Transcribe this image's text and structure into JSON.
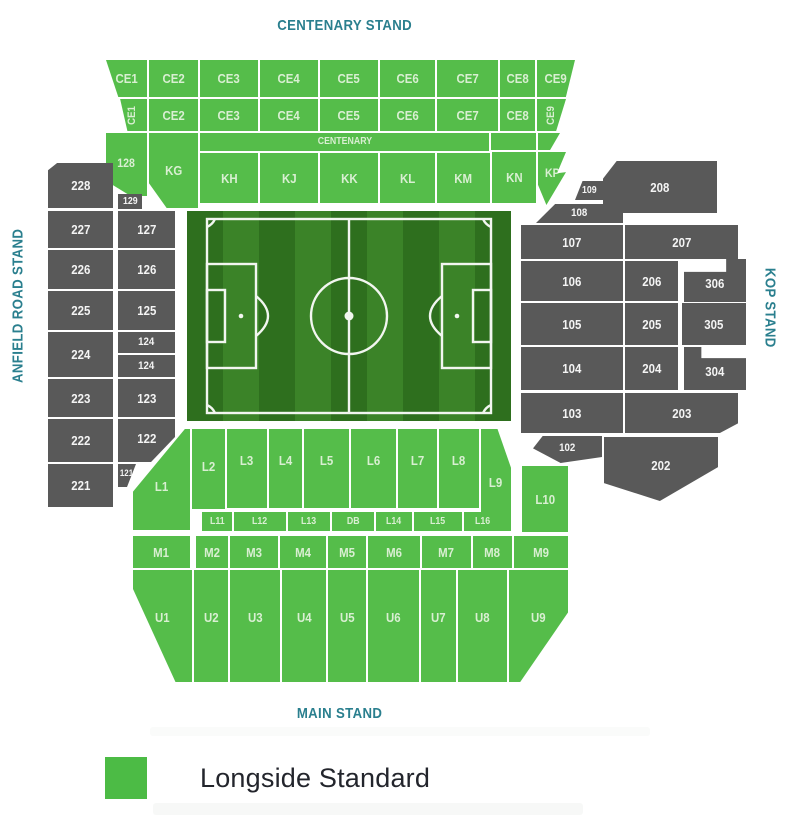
{
  "stands": {
    "top": "CENTENARY STAND",
    "left": "ANFIELD ROAD STAND",
    "right": "KOP STAND",
    "bottom": "MAIN STAND"
  },
  "legend": {
    "items": [
      {
        "label": "Longside Standard",
        "color": "#4cbb45",
        "category": "available"
      }
    ]
  },
  "colors": {
    "green": "#55bd4a",
    "green_text": "#d9efd2",
    "gray": "#595959",
    "gray_text": "#f4f4f4",
    "teal": "#2a7f8e",
    "legend_text": "#23252c",
    "pitch_dark": "#2e6f1e",
    "pitch_light": "#3b8328",
    "pitch_line": "#f2f6f0"
  },
  "pitch": {
    "stripes": 9,
    "x": 187,
    "y": 211,
    "w": 324,
    "h": 210
  },
  "sections": [
    {
      "id": "CE1-upper",
      "label": "CE1",
      "status": "available",
      "x": 106,
      "y": 60,
      "w": 41,
      "h": 37,
      "clip": "polygon(0 0,100% 0,100% 100%,30% 100%)"
    },
    {
      "id": "CE2-upper",
      "label": "CE2",
      "status": "available",
      "x": 149,
      "y": 60,
      "w": 49,
      "h": 37
    },
    {
      "id": "CE3-upper",
      "label": "CE3",
      "status": "available",
      "x": 200,
      "y": 60,
      "w": 58,
      "h": 37
    },
    {
      "id": "CE4-upper",
      "label": "CE4",
      "status": "available",
      "x": 260,
      "y": 60,
      "w": 58,
      "h": 37
    },
    {
      "id": "CE5-upper",
      "label": "CE5",
      "status": "available",
      "x": 320,
      "y": 60,
      "w": 58,
      "h": 37
    },
    {
      "id": "CE6-upper",
      "label": "CE6",
      "status": "available",
      "x": 380,
      "y": 60,
      "w": 55,
      "h": 37
    },
    {
      "id": "CE7-upper",
      "label": "CE7",
      "status": "available",
      "x": 437,
      "y": 60,
      "w": 61,
      "h": 37
    },
    {
      "id": "CE8-upper",
      "label": "CE8",
      "status": "available",
      "x": 500,
      "y": 60,
      "w": 35,
      "h": 37
    },
    {
      "id": "CE9-upper",
      "label": "CE9",
      "status": "available",
      "x": 537,
      "y": 60,
      "w": 38,
      "h": 37,
      "clip": "polygon(0 0,100% 0,76% 100%,0 100%)"
    },
    {
      "id": "CE1-lower",
      "label": "CE1",
      "status": "available",
      "x": 119,
      "y": 99,
      "w": 28,
      "h": 32,
      "rot": true,
      "fs": 11,
      "clip": "polygon(4% 0,100% 0,100% 100%,30% 100%)"
    },
    {
      "id": "CE2-lower",
      "label": "CE2",
      "status": "available",
      "x": 149,
      "y": 99,
      "w": 49,
      "h": 32
    },
    {
      "id": "CE3-lower",
      "label": "CE3",
      "status": "available",
      "x": 200,
      "y": 99,
      "w": 58,
      "h": 32
    },
    {
      "id": "CE4-lower",
      "label": "CE4",
      "status": "available",
      "x": 260,
      "y": 99,
      "w": 58,
      "h": 32
    },
    {
      "id": "CE5-lower",
      "label": "CE5",
      "status": "available",
      "x": 320,
      "y": 99,
      "w": 58,
      "h": 32
    },
    {
      "id": "CE6-lower",
      "label": "CE6",
      "status": "available",
      "x": 380,
      "y": 99,
      "w": 55,
      "h": 32
    },
    {
      "id": "CE7-lower",
      "label": "CE7",
      "status": "available",
      "x": 437,
      "y": 99,
      "w": 61,
      "h": 32
    },
    {
      "id": "CE8-lower",
      "label": "CE8",
      "status": "available",
      "x": 500,
      "y": 99,
      "w": 35,
      "h": 32
    },
    {
      "id": "CE9-lower",
      "label": "CE9",
      "status": "available",
      "x": 537,
      "y": 99,
      "w": 29,
      "h": 32,
      "rot": true,
      "fs": 11,
      "clip": "polygon(0 0,100% 0,66% 100%,0 100%)"
    },
    {
      "id": "centenary-banner",
      "label": "CENTENARY",
      "status": "available",
      "x": 200,
      "y": 133,
      "w": 289,
      "h": 18,
      "fs": 10
    },
    {
      "id": "filler-kn",
      "label": "",
      "status": "available",
      "x": 491,
      "y": 133,
      "w": 45,
      "h": 17
    },
    {
      "id": "filler-kp",
      "label": "",
      "status": "available",
      "x": 538,
      "y": 133,
      "w": 22,
      "h": 17,
      "clip": "polygon(0 0,100% 0,55% 100%,0 100%)"
    },
    {
      "id": "128",
      "label": "128",
      "status": "available",
      "x": 106,
      "y": 133,
      "w": 41,
      "h": 63,
      "fs": 12,
      "dy": -4,
      "clip": "polygon(0 0,100% 0,100% 100%,60% 100%,0 76%)"
    },
    {
      "id": "KG",
      "label": "KG",
      "status": "available",
      "x": 149,
      "y": 133,
      "w": 49,
      "h": 75,
      "clip": "polygon(0 0,100% 0,100% 100%,36% 100%,0 67%)"
    },
    {
      "id": "KH",
      "label": "KH",
      "status": "available",
      "x": 200,
      "y": 153,
      "w": 58,
      "h": 50
    },
    {
      "id": "KJ",
      "label": "KJ",
      "status": "available",
      "x": 260,
      "y": 153,
      "w": 58,
      "h": 50
    },
    {
      "id": "KK",
      "label": "KK",
      "status": "available",
      "x": 320,
      "y": 153,
      "w": 58,
      "h": 50
    },
    {
      "id": "KL",
      "label": "KL",
      "status": "available",
      "x": 380,
      "y": 153,
      "w": 55,
      "h": 50
    },
    {
      "id": "KM",
      "label": "KM",
      "status": "available",
      "x": 437,
      "y": 153,
      "w": 53,
      "h": 50
    },
    {
      "id": "KN",
      "label": "KN",
      "status": "available",
      "x": 492,
      "y": 152,
      "w": 44,
      "h": 51
    },
    {
      "id": "KP",
      "label": "KP",
      "status": "available",
      "x": 538,
      "y": 152,
      "w": 28,
      "h": 53,
      "fs": 12,
      "dy": -12,
      "clip": "polygon(0 0,100% 0,68% 40%,100% 38%,30% 100%,0 62%)"
    },
    {
      "id": "109",
      "label": "109",
      "status": "unavailable",
      "x": 575,
      "y": 181,
      "w": 29,
      "h": 19,
      "fs": 10,
      "clip": "polygon(26% 0,100% 0,100% 100%,0 100%)"
    },
    {
      "id": "208",
      "label": "208",
      "status": "unavailable",
      "x": 603,
      "y": 161,
      "w": 114,
      "h": 52,
      "clip": "polygon(0 34%,12% 0,100% 0,100% 100%,0 100%)"
    },
    {
      "id": "108",
      "label": "108",
      "status": "unavailable",
      "x": 536,
      "y": 204,
      "w": 87,
      "h": 19,
      "fs": 11,
      "clip": "polygon(22% 0,100% 0,100% 100%,0 100%)"
    },
    {
      "id": "107",
      "label": "107",
      "status": "unavailable",
      "x": 521,
      "y": 225,
      "w": 102,
      "h": 34
    },
    {
      "id": "207",
      "label": "207",
      "status": "unavailable",
      "x": 625,
      "y": 225,
      "w": 113,
      "h": 34
    },
    {
      "id": "106",
      "label": "106",
      "status": "unavailable",
      "x": 521,
      "y": 261,
      "w": 102,
      "h": 40
    },
    {
      "id": "206",
      "label": "206",
      "status": "unavailable",
      "x": 625,
      "y": 261,
      "w": 53,
      "h": 40
    },
    {
      "id": "306",
      "label": "306",
      "status": "unavailable",
      "x": 684,
      "y": 259,
      "w": 62,
      "h": 43,
      "dy": 5,
      "clip": "polygon(0 30%,68% 30%,68% 0,100% 0,100% 100%,0 100%)"
    },
    {
      "id": "105",
      "label": "105",
      "status": "unavailable",
      "x": 521,
      "y": 303,
      "w": 102,
      "h": 42
    },
    {
      "id": "205",
      "label": "205",
      "status": "unavailable",
      "x": 625,
      "y": 303,
      "w": 53,
      "h": 42
    },
    {
      "id": "305",
      "label": "305",
      "status": "unavailable",
      "x": 682,
      "y": 303,
      "w": 64,
      "h": 42
    },
    {
      "id": "104",
      "label": "104",
      "status": "unavailable",
      "x": 521,
      "y": 347,
      "w": 102,
      "h": 43
    },
    {
      "id": "204",
      "label": "204",
      "status": "unavailable",
      "x": 625,
      "y": 347,
      "w": 53,
      "h": 43
    },
    {
      "id": "304",
      "label": "304",
      "status": "unavailable",
      "x": 684,
      "y": 347,
      "w": 62,
      "h": 43,
      "dy": 5,
      "clip": "polygon(0 0,28% 0,28% 26%,100% 26%,100% 100%,0 100%)"
    },
    {
      "id": "103",
      "label": "103",
      "status": "unavailable",
      "x": 521,
      "y": 393,
      "w": 102,
      "h": 40
    },
    {
      "id": "203",
      "label": "203",
      "status": "unavailable",
      "x": 625,
      "y": 393,
      "w": 113,
      "h": 40,
      "clip": "polygon(0 0,100% 0,100% 76%,84% 100%,0 100%)"
    },
    {
      "id": "102",
      "label": "102",
      "status": "unavailable",
      "x": 533,
      "y": 436,
      "w": 69,
      "h": 27,
      "fs": 11,
      "dy": -3,
      "clip": "polygon(14% 0,100% 0,100% 78%,40% 100%,0 46%)"
    },
    {
      "id": "202",
      "label": "202",
      "status": "unavailable",
      "x": 604,
      "y": 437,
      "w": 114,
      "h": 64,
      "dy": -8,
      "clip": "polygon(0 0,100% 0,100% 47%,49% 100%,0 72%)"
    },
    {
      "id": "228",
      "label": "228",
      "status": "unavailable",
      "x": 48,
      "y": 163,
      "w": 65,
      "h": 45,
      "clip": "polygon(0 16%,14% 0,100% 0,100% 100%,0 100%)"
    },
    {
      "id": "129",
      "label": "129",
      "status": "unavailable",
      "x": 118,
      "y": 194,
      "w": 24,
      "h": 15,
      "fs": 10
    },
    {
      "id": "227",
      "label": "227",
      "status": "unavailable",
      "x": 48,
      "y": 211,
      "w": 65,
      "h": 37
    },
    {
      "id": "127",
      "label": "127",
      "status": "unavailable",
      "x": 118,
      "y": 211,
      "w": 57,
      "h": 37
    },
    {
      "id": "226",
      "label": "226",
      "status": "unavailable",
      "x": 48,
      "y": 250,
      "w": 65,
      "h": 39
    },
    {
      "id": "126",
      "label": "126",
      "status": "unavailable",
      "x": 118,
      "y": 250,
      "w": 57,
      "h": 39
    },
    {
      "id": "225",
      "label": "225",
      "status": "unavailable",
      "x": 48,
      "y": 291,
      "w": 65,
      "h": 39
    },
    {
      "id": "125",
      "label": "125",
      "status": "unavailable",
      "x": 118,
      "y": 291,
      "w": 57,
      "h": 39
    },
    {
      "id": "224",
      "label": "224",
      "status": "unavailable",
      "x": 48,
      "y": 332,
      "w": 65,
      "h": 45
    },
    {
      "id": "124-upper",
      "label": "124",
      "status": "unavailable",
      "x": 118,
      "y": 332,
      "w": 57,
      "h": 21,
      "fs": 11
    },
    {
      "id": "124-lower",
      "label": "124",
      "status": "unavailable",
      "x": 118,
      "y": 355,
      "w": 57,
      "h": 22,
      "fs": 11
    },
    {
      "id": "223",
      "label": "223",
      "status": "unavailable",
      "x": 48,
      "y": 379,
      "w": 65,
      "h": 38
    },
    {
      "id": "123",
      "label": "123",
      "status": "unavailable",
      "x": 118,
      "y": 379,
      "w": 57,
      "h": 38
    },
    {
      "id": "222",
      "label": "222",
      "status": "unavailable",
      "x": 48,
      "y": 419,
      "w": 65,
      "h": 43
    },
    {
      "id": "122",
      "label": "122",
      "status": "unavailable",
      "x": 118,
      "y": 419,
      "w": 57,
      "h": 43,
      "dy": -4,
      "clip": "polygon(0 0,100% 0,100% 42%,58% 100%,0 100%)"
    },
    {
      "id": "221",
      "label": "221",
      "status": "unavailable",
      "x": 48,
      "y": 464,
      "w": 65,
      "h": 43
    },
    {
      "id": "121",
      "label": "121",
      "status": "unavailable",
      "x": 118,
      "y": 464,
      "w": 18,
      "h": 23,
      "fs": 9,
      "dy": -5,
      "clip": "polygon(0 0,100% 0,50% 100%,0 100%)"
    },
    {
      "id": "L1",
      "label": "L1",
      "status": "available",
      "x": 133,
      "y": 429,
      "w": 57,
      "h": 101,
      "dy": 14,
      "clip": "polygon(91% 0,100% 0,100% 100%,0 100%,0 62%)"
    },
    {
      "id": "L2",
      "label": "L2",
      "status": "available",
      "x": 192,
      "y": 429,
      "w": 33,
      "h": 80,
      "dy": -6
    },
    {
      "id": "L3",
      "label": "L3",
      "status": "available",
      "x": 227,
      "y": 429,
      "w": 40,
      "h": 79,
      "dy": -16
    },
    {
      "id": "L4",
      "label": "L4",
      "status": "available",
      "x": 269,
      "y": 429,
      "w": 33,
      "h": 79,
      "dy": -16
    },
    {
      "id": "L5",
      "label": "L5",
      "status": "available",
      "x": 304,
      "y": 429,
      "w": 45,
      "h": 79,
      "dy": -16
    },
    {
      "id": "L6",
      "label": "L6",
      "status": "available",
      "x": 351,
      "y": 429,
      "w": 45,
      "h": 79,
      "dy": -16
    },
    {
      "id": "L7",
      "label": "L7",
      "status": "available",
      "x": 398,
      "y": 429,
      "w": 39,
      "h": 79,
      "dy": -16
    },
    {
      "id": "L8",
      "label": "L8",
      "status": "available",
      "x": 439,
      "y": 429,
      "w": 40,
      "h": 79,
      "dy": -16
    },
    {
      "id": "L9",
      "label": "L9",
      "status": "available",
      "x": 481,
      "y": 429,
      "w": 30,
      "h": 102,
      "dy": 4,
      "clip": "polygon(0 0,55% 0,100% 38%,100% 100%,0 100%)"
    },
    {
      "id": "L10",
      "label": "L10",
      "status": "available",
      "x": 522,
      "y": 466,
      "w": 46,
      "h": 66
    },
    {
      "id": "L11",
      "label": "L11",
      "status": "available",
      "x": 202,
      "y": 512,
      "w": 30,
      "h": 19,
      "fs": 10
    },
    {
      "id": "L12",
      "label": "L12",
      "status": "available",
      "x": 234,
      "y": 512,
      "w": 52,
      "h": 19,
      "fs": 10
    },
    {
      "id": "L13",
      "label": "L13",
      "status": "available",
      "x": 288,
      "y": 512,
      "w": 42,
      "h": 19,
      "fs": 10
    },
    {
      "id": "DB",
      "label": "DB",
      "status": "available",
      "x": 332,
      "y": 512,
      "w": 42,
      "h": 19,
      "fs": 10
    },
    {
      "id": "L14",
      "label": "L14",
      "status": "available",
      "x": 376,
      "y": 512,
      "w": 36,
      "h": 19,
      "fs": 10
    },
    {
      "id": "L15",
      "label": "L15",
      "status": "available",
      "x": 414,
      "y": 512,
      "w": 48,
      "h": 19,
      "fs": 10
    },
    {
      "id": "L16",
      "label": "L16",
      "status": "available",
      "x": 464,
      "y": 512,
      "w": 38,
      "h": 19,
      "fs": 10
    },
    {
      "id": "M1",
      "label": "M1",
      "status": "available",
      "x": 133,
      "y": 536,
      "w": 57,
      "h": 32
    },
    {
      "id": "M2",
      "label": "M2",
      "status": "available",
      "x": 196,
      "y": 536,
      "w": 32,
      "h": 32
    },
    {
      "id": "M3",
      "label": "M3",
      "status": "available",
      "x": 230,
      "y": 536,
      "w": 48,
      "h": 32
    },
    {
      "id": "M4",
      "label": "M4",
      "status": "available",
      "x": 280,
      "y": 536,
      "w": 46,
      "h": 32
    },
    {
      "id": "M5",
      "label": "M5",
      "status": "available",
      "x": 328,
      "y": 536,
      "w": 38,
      "h": 32
    },
    {
      "id": "M6",
      "label": "M6",
      "status": "available",
      "x": 368,
      "y": 536,
      "w": 52,
      "h": 32
    },
    {
      "id": "M7",
      "label": "M7",
      "status": "available",
      "x": 422,
      "y": 536,
      "w": 49,
      "h": 32
    },
    {
      "id": "M8",
      "label": "M8",
      "status": "available",
      "x": 473,
      "y": 536,
      "w": 39,
      "h": 32
    },
    {
      "id": "M9",
      "label": "M9",
      "status": "available",
      "x": 514,
      "y": 536,
      "w": 54,
      "h": 32
    },
    {
      "id": "U1",
      "label": "U1",
      "status": "available",
      "x": 133,
      "y": 570,
      "w": 59,
      "h": 112,
      "dy": -18,
      "clip": "polygon(0 0,100% 0,100% 100%,72% 100%,0 17%)"
    },
    {
      "id": "U2",
      "label": "U2",
      "status": "available",
      "x": 194,
      "y": 570,
      "w": 34,
      "h": 112,
      "dy": -18
    },
    {
      "id": "U3",
      "label": "U3",
      "status": "available",
      "x": 230,
      "y": 570,
      "w": 50,
      "h": 112,
      "dy": -18
    },
    {
      "id": "U4",
      "label": "U4",
      "status": "available",
      "x": 282,
      "y": 570,
      "w": 44,
      "h": 112,
      "dy": -18
    },
    {
      "id": "U5",
      "label": "U5",
      "status": "available",
      "x": 328,
      "y": 570,
      "w": 38,
      "h": 112,
      "dy": -18
    },
    {
      "id": "U6",
      "label": "U6",
      "status": "available",
      "x": 368,
      "y": 570,
      "w": 51,
      "h": 112,
      "dy": -18
    },
    {
      "id": "U7",
      "label": "U7",
      "status": "available",
      "x": 421,
      "y": 570,
      "w": 35,
      "h": 112,
      "dy": -18
    },
    {
      "id": "U8",
      "label": "U8",
      "status": "available",
      "x": 458,
      "y": 570,
      "w": 49,
      "h": 112,
      "dy": -18
    },
    {
      "id": "U9",
      "label": "U9",
      "status": "available",
      "x": 509,
      "y": 570,
      "w": 59,
      "h": 112,
      "dy": -18,
      "clip": "polygon(0 0,100% 0,100% 38%,19% 100%,0 100%)"
    }
  ]
}
